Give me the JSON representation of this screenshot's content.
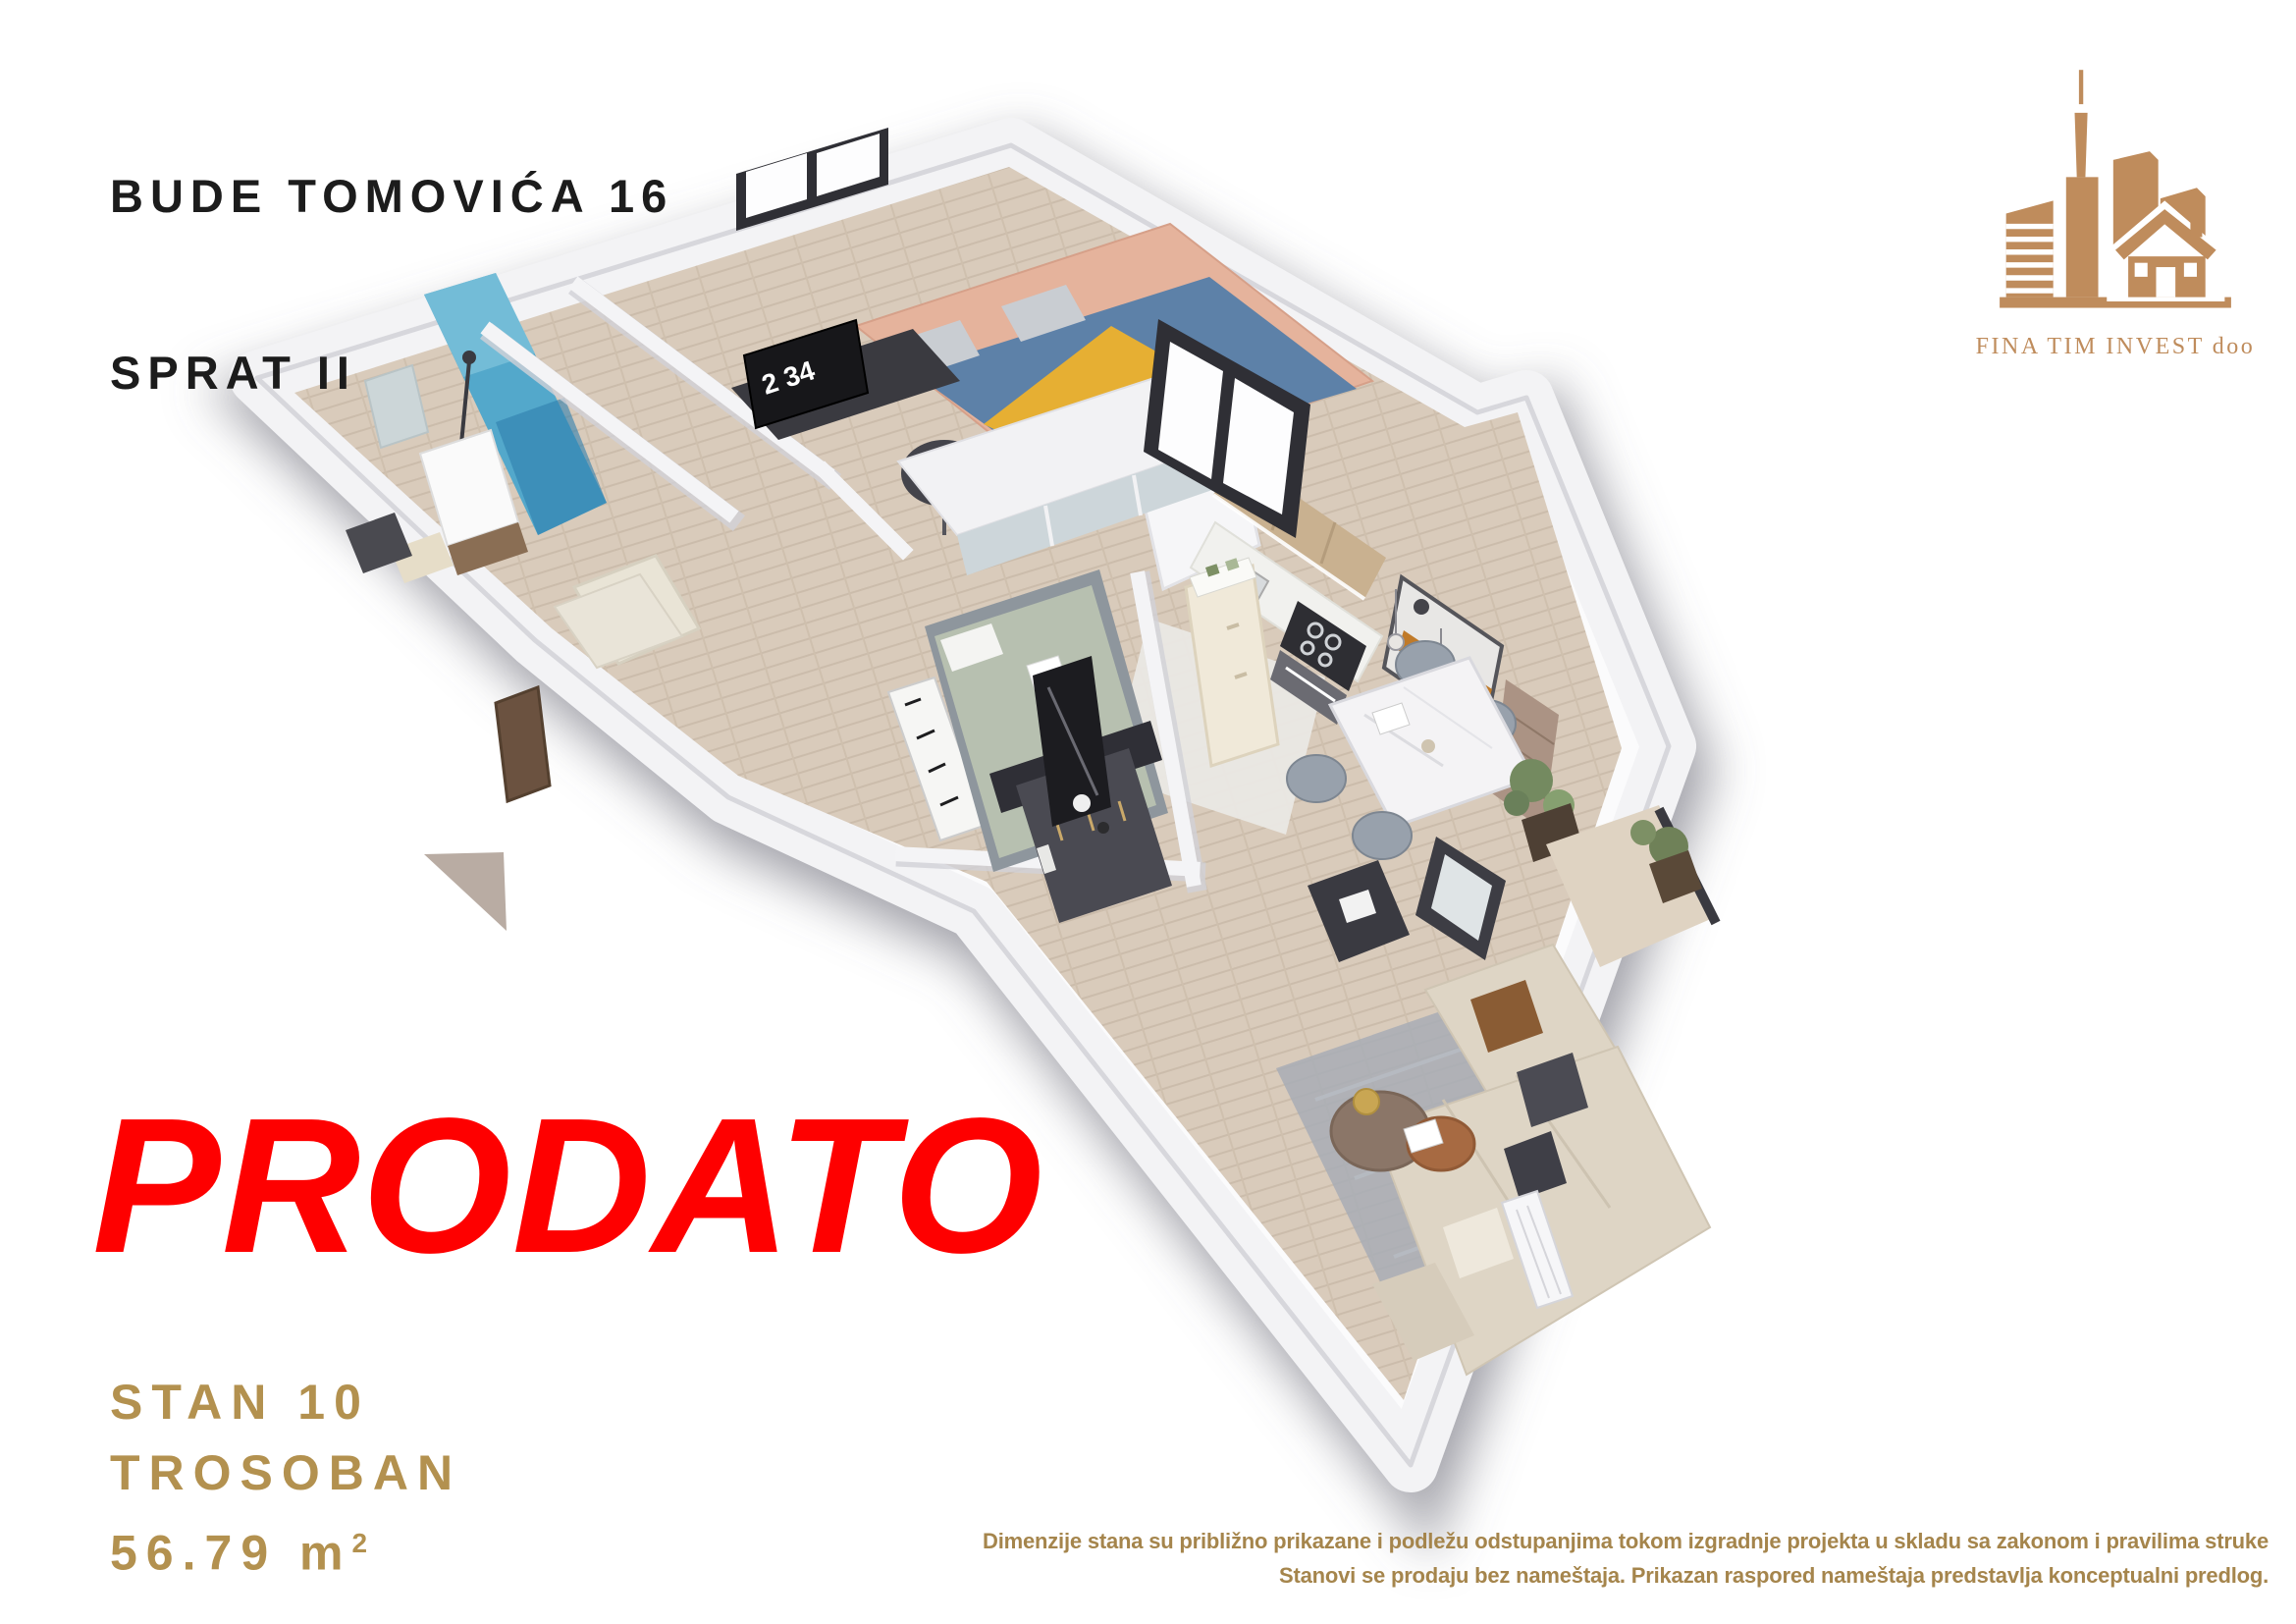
{
  "header": {
    "address_line1": "BUDE TOMOVIĆA 16",
    "address_line2": "SPRAT II"
  },
  "logo": {
    "company": "FINA TIM INVEST doo",
    "brand_color": "#BF8C5C"
  },
  "stamp": {
    "text": "PRODATO",
    "color": "#FE0000"
  },
  "unit": {
    "number": "STAN 10",
    "layout": "TROSOBAN",
    "area_value": "56.79 m",
    "area_superscript": "2",
    "text_color": "#B3914F"
  },
  "disclaimer": {
    "line1": "Dimenzije stana su približno prikazane i podležu odstupanjima tokom izgradnje projekta u skladu sa zakonom i pravilima struke",
    "line2": "Stanovi se prodaju bez nameštaja. Prikazan raspored nameštaja predstavlja konceptualni predlog.",
    "color": "#A5854C"
  },
  "floorplan": {
    "clock_display": "2 34",
    "colors": {
      "wall": "#F3F3F5",
      "wood_floor": "#D9CBBB",
      "terrazzo_floor": "#EAE8E4",
      "shower_tile": "#53A8CB",
      "bed1_duvet_blue": "#5D81A8",
      "bed1_band_yellow": "#E6AF33",
      "bed1_headboard_peach": "#E5B39C",
      "bed2_sage": "#B7C0B0",
      "sofa_beige": "#DED5C5",
      "kitchen_wood": "#C9B190",
      "fridge_cream": "#F0E9D9",
      "art_orange": "#C07A28",
      "art_blue": "#7A8FA0",
      "brick": "#AB9384",
      "plant_green": "#748A60"
    }
  }
}
